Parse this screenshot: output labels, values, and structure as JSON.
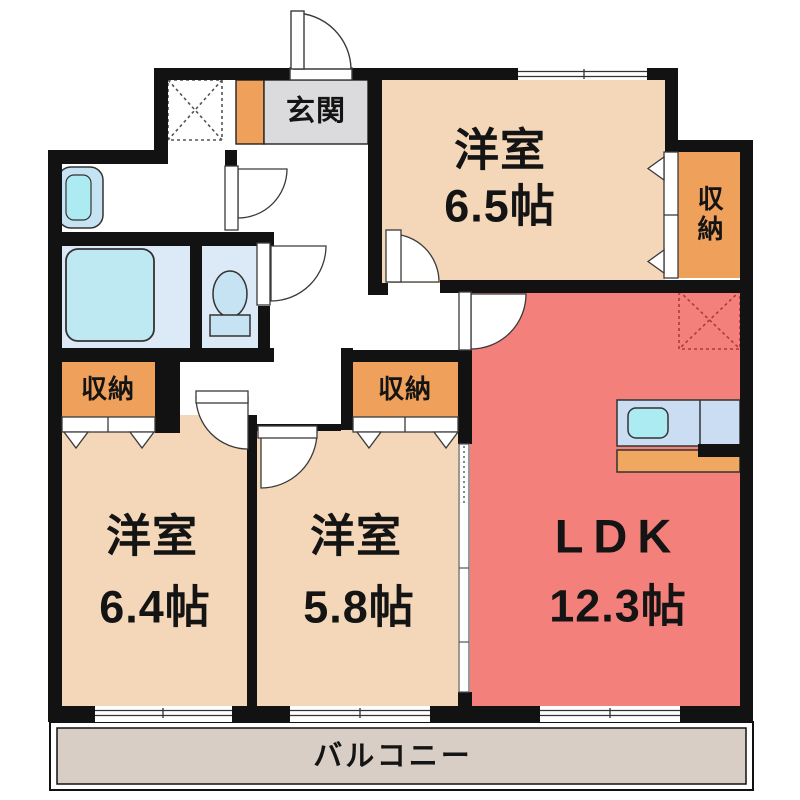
{
  "plan": {
    "title": "間取り図",
    "entrance": {
      "label": "玄関"
    },
    "rooms": [
      {
        "id": "western-room-6-5",
        "label": "洋室",
        "area": "6.5帖"
      },
      {
        "id": "western-room-6-4",
        "label": "洋室",
        "area": "6.4帖"
      },
      {
        "id": "western-room-5-8",
        "label": "洋室",
        "area": "5.8帖"
      },
      {
        "id": "ldk",
        "label": "LDK",
        "area": "12.3帖"
      }
    ],
    "closets": [
      {
        "label": "収納"
      },
      {
        "label": "収納"
      },
      {
        "label": "収納"
      }
    ],
    "balcony": {
      "label": "バルコニー"
    }
  },
  "colors": {
    "wall": "#121212",
    "room_beige": "#F4D7B8",
    "ldk_pink": "#F3807B",
    "closet_orange": "#EFA05A",
    "genkan_gray": "#DBDBDD",
    "balcony_gray": "#D8CEC6",
    "bath_floor_blue": "#DCEAF8",
    "fixture_blue": "#C5E3F2",
    "tub_cyan": "#BFE9F2",
    "sink_cyan": "#ADEBF2",
    "counter_blue": "#CADDF2",
    "cabinet_orange": "#F0A860",
    "ps_red": "#B03A3A"
  }
}
